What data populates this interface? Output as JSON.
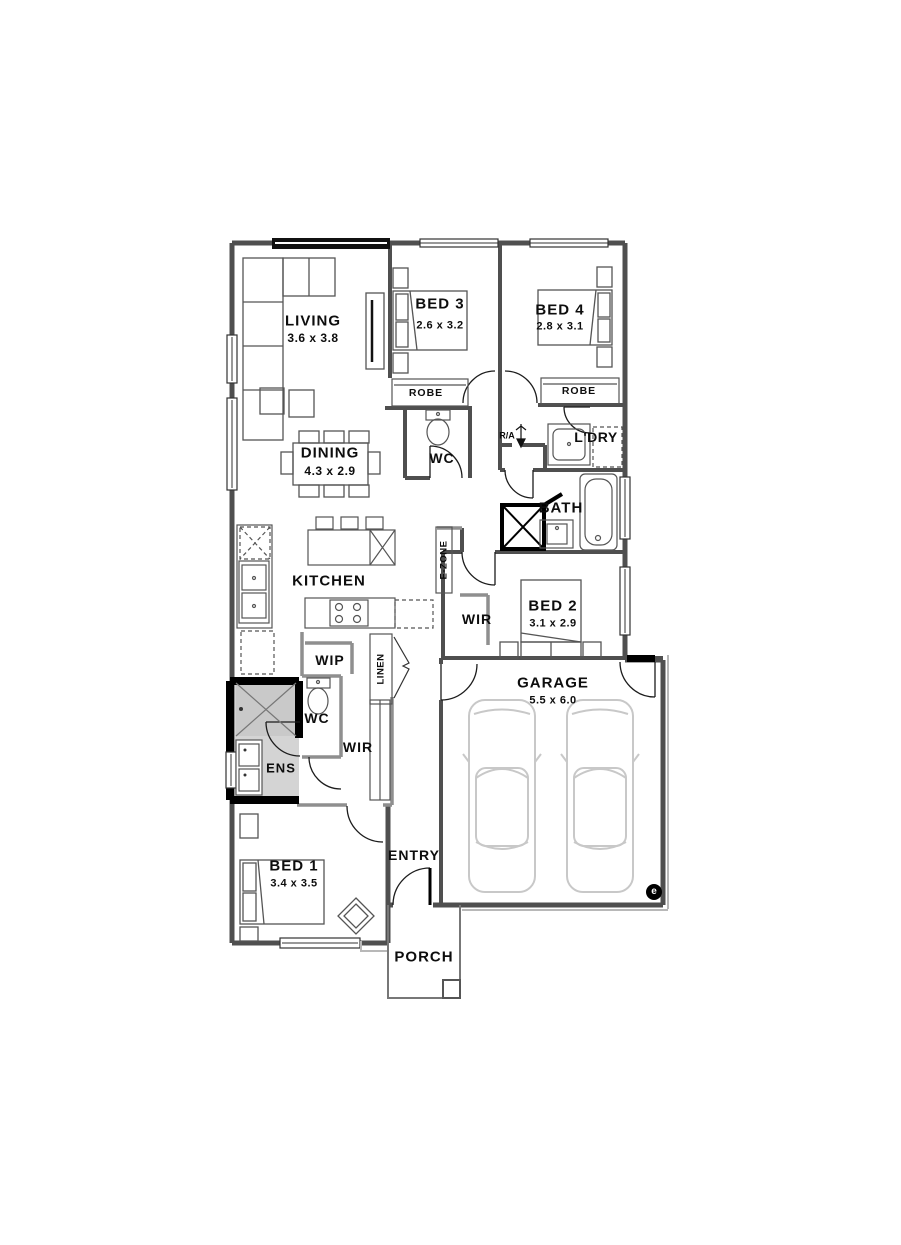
{
  "plan": {
    "rooms": {
      "living": {
        "label": "LIVING",
        "dims": "3.6 x 3.8"
      },
      "dining": {
        "label": "DINING",
        "dims": "4.3 x 2.9"
      },
      "kitchen": {
        "label": "KITCHEN"
      },
      "bed1": {
        "label": "BED 1",
        "dims": "3.4 x 3.5"
      },
      "bed2": {
        "label": "BED 2",
        "dims": "3.1 x 2.9"
      },
      "bed3": {
        "label": "BED 3",
        "dims": "2.6 x 3.2"
      },
      "bed4": {
        "label": "BED 4",
        "dims": "2.8 x 3.1"
      },
      "bath": {
        "label": "BATH"
      },
      "garage": {
        "label": "GARAGE",
        "dims": "5.5 x 6.0"
      },
      "entry": {
        "label": "ENTRY"
      },
      "porch": {
        "label": "PORCH"
      }
    },
    "fixtures": {
      "robe3": "ROBE",
      "robe4": "ROBE",
      "wc_upper": "WC",
      "ra": "R/A",
      "ldry": "L'DRY",
      "ezone": "E-ZONE",
      "wir_bed2": "WIR",
      "wip": "WIP",
      "linen": "LINEN",
      "wc_lower": "WC",
      "wir_lower": "WIR",
      "ens": "ENS"
    },
    "meter": "e",
    "colors": {
      "wall": "#4f4f4f",
      "wall_light": "#8f8f8f",
      "ens_fill": "#d4d4d4",
      "car": "#c8c8c8",
      "black": "#000000"
    }
  }
}
